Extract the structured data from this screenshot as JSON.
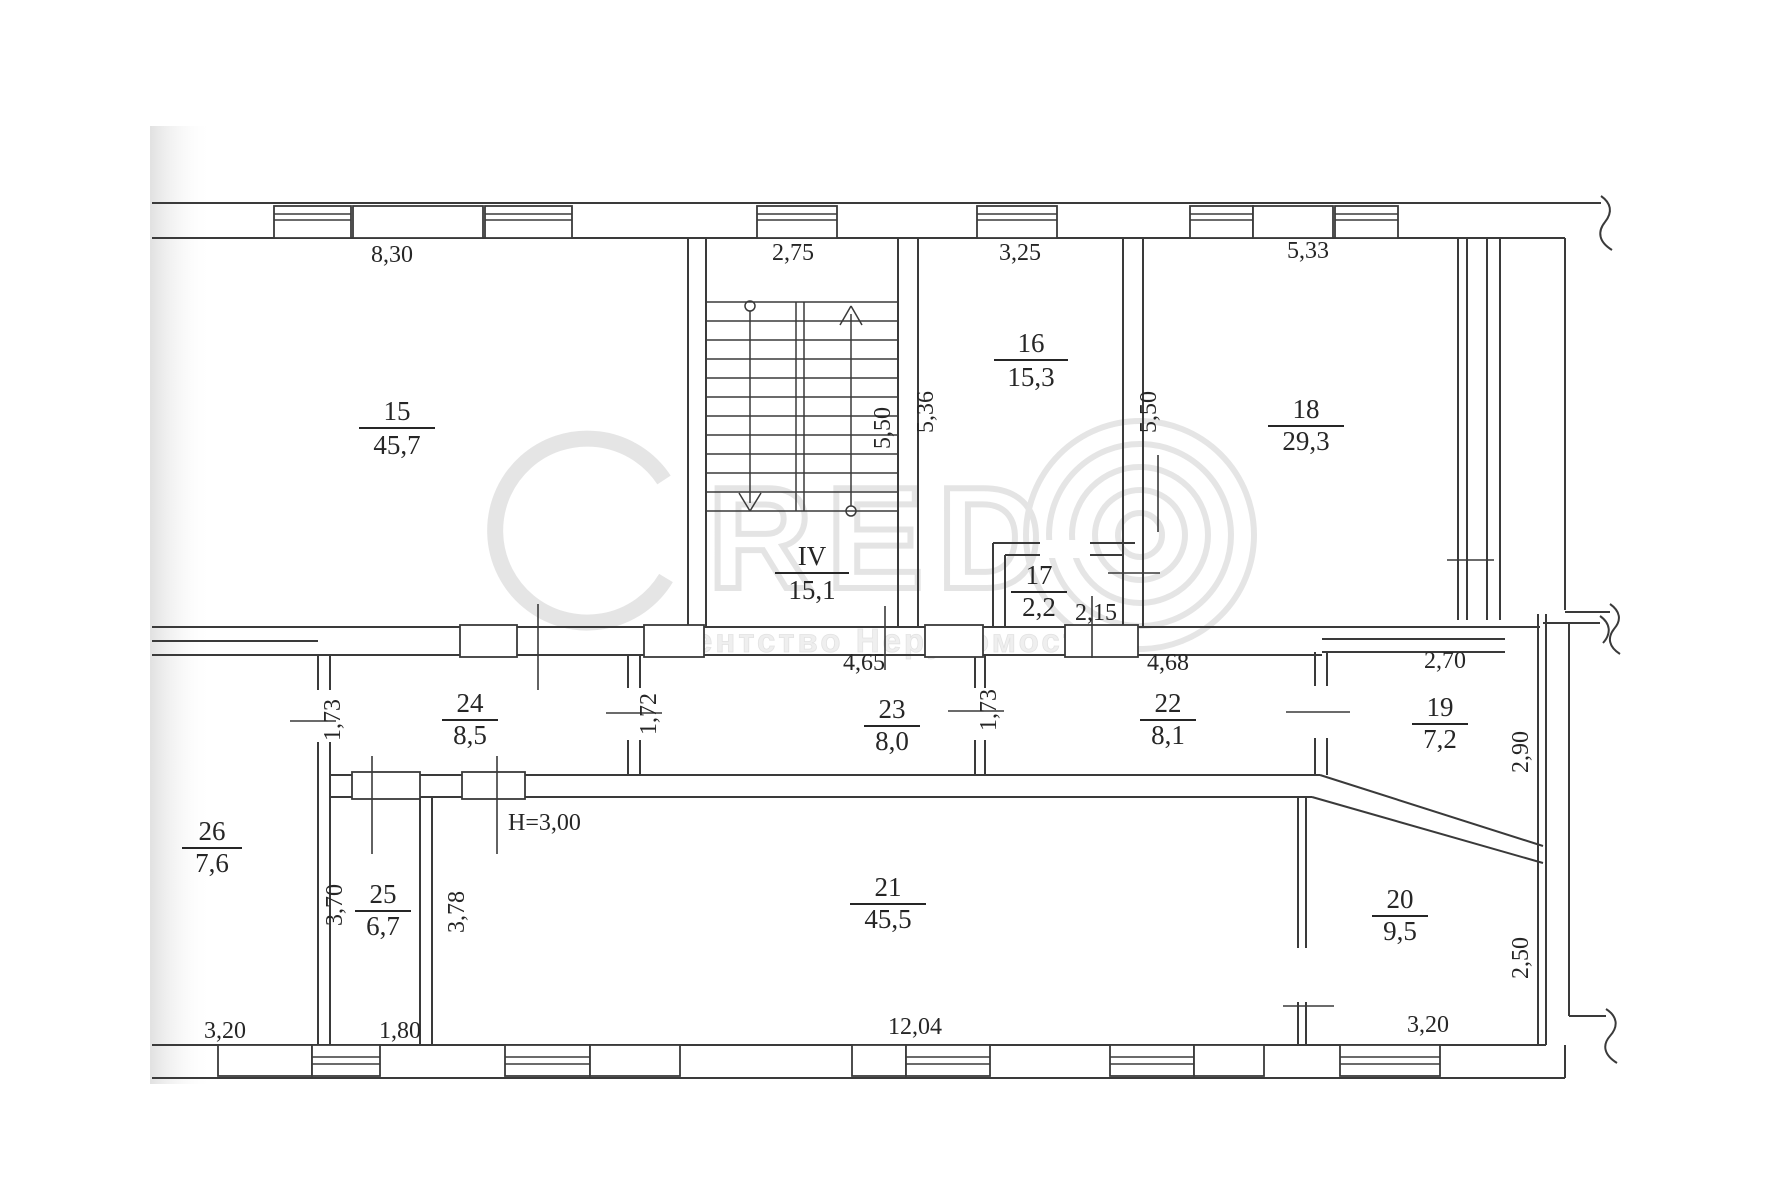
{
  "watermark": {
    "brand_letters": "RED",
    "agency_text": "агентство Нерухомості"
  },
  "rooms": [
    {
      "number": "15",
      "area": "45,7"
    },
    {
      "number": "IV",
      "area": "15,1"
    },
    {
      "number": "16",
      "area": "15,3"
    },
    {
      "number": "17",
      "area": "2,2"
    },
    {
      "number": "18",
      "area": "29,3"
    },
    {
      "number": "19",
      "area": "7,2"
    },
    {
      "number": "20",
      "area": "9,5"
    },
    {
      "number": "21",
      "area": "45,5"
    },
    {
      "number": "22",
      "area": "8,1"
    },
    {
      "number": "23",
      "area": "8,0"
    },
    {
      "number": "24",
      "area": "8,5"
    },
    {
      "number": "25",
      "area": "6,7"
    },
    {
      "number": "26",
      "area": "7,6"
    }
  ],
  "dimensions": {
    "top_room15": "8,30",
    "top_stair": "2,75",
    "top_room16": "3,25",
    "top_room18": "5,33",
    "stair_depth": "5,50",
    "room16_left": "5,36",
    "room18_left": "5,50",
    "opening_17": "2,15",
    "room23_width": "4,65",
    "room22_width": "4,68",
    "room19_width": "2,70",
    "room24_height": "1,73",
    "room23_height": "1,72",
    "room22_height": "1,73",
    "room19_right": "2,90",
    "room25_height": "3,70",
    "room21_left": "3,78",
    "room20_right": "2,50",
    "room25_width": "1,80",
    "room26_width": "3,20",
    "room21_width": "12,04",
    "room20_width": "3,20",
    "ceiling_height": "H=3,00"
  }
}
